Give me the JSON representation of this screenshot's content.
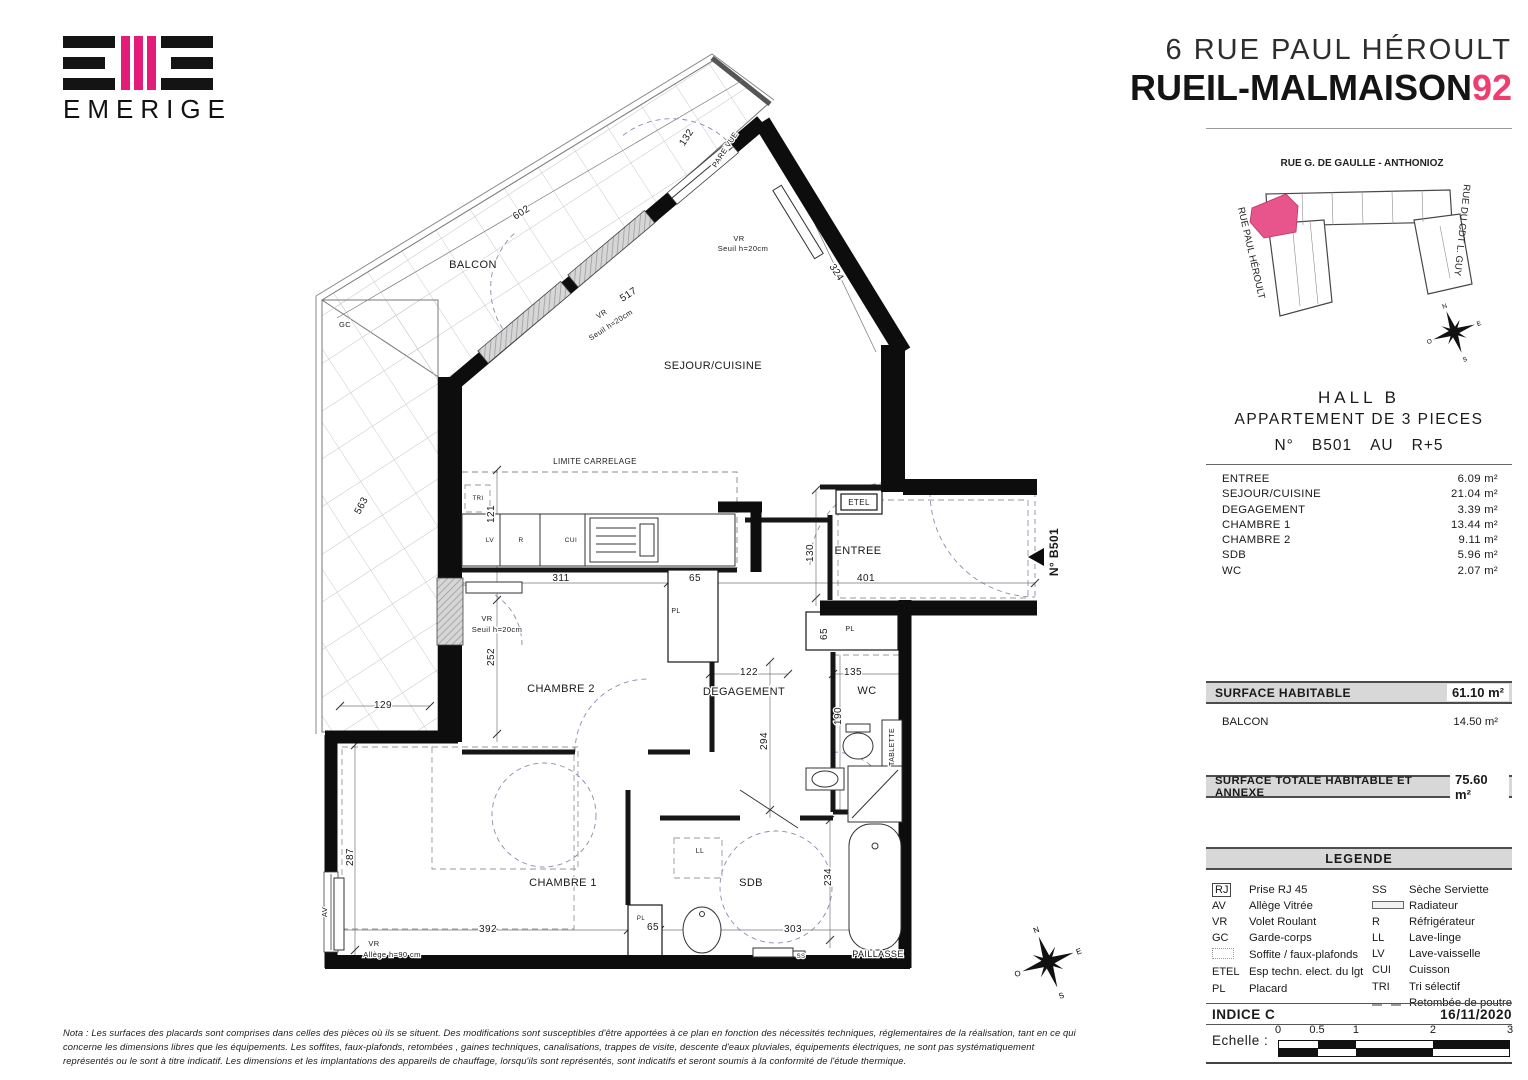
{
  "header": {
    "brand": "EMERIGE",
    "address_line": "6 RUE PAUL HÉROULT",
    "city_line": "RUEIL-MALMAISON",
    "dept": "92"
  },
  "colors": {
    "accent_pink": "#ee3d6e",
    "logo_pink": "#e31c79",
    "map_unit_pink": "#e8548c"
  },
  "map": {
    "street_top": "RUE G. DE GAULLE - ANTHONIOZ",
    "street_left": "RUE PAUL HÉROULT",
    "street_right": "RUE DU CDT L. GUY",
    "compass": {
      "n": "N",
      "e": "E",
      "s": "S",
      "o": "O"
    }
  },
  "unit": {
    "hall": "HALL  B",
    "type": "APPARTEMENT DE 3 PIECES",
    "number_label": "N°",
    "number": "B501",
    "floor_label": "AU",
    "floor": "R+5"
  },
  "rooms": [
    {
      "name": "ENTREE",
      "area": "6.09 m²"
    },
    {
      "name": "SEJOUR/CUISINE",
      "area": "21.04 m²"
    },
    {
      "name": "DEGAGEMENT",
      "area": "3.39 m²"
    },
    {
      "name": "CHAMBRE 1",
      "area": "13.44 m²"
    },
    {
      "name": "CHAMBRE 2",
      "area": "9.11 m²"
    },
    {
      "name": "SDB",
      "area": "5.96 m²"
    },
    {
      "name": "WC",
      "area": "2.07 m²"
    }
  ],
  "surfaces": {
    "habitable_label": "SURFACE HABITABLE",
    "habitable_value": "61.10 m²",
    "balcon_label": "BALCON",
    "balcon_value": "14.50 m²",
    "total_label": "SURFACE TOTALE HABITABLE ET ANNEXE",
    "total_value": "75.60 m²"
  },
  "legend": {
    "title": "LEGENDE",
    "left": [
      {
        "code": "RJ",
        "boxed": true,
        "label": "Prise RJ 45"
      },
      {
        "code": "AV",
        "label": "Allège Vitrée"
      },
      {
        "code": "VR",
        "label": "Volet Roulant"
      },
      {
        "code": "GC",
        "label": "Garde-corps"
      },
      {
        "code": "",
        "swatch": "dotted",
        "label": "Soffite / faux-plafonds"
      },
      {
        "code": "ETEL",
        "label": "Esp techn. elect. du lgt"
      },
      {
        "code": "PL",
        "label": "Placard"
      }
    ],
    "right": [
      {
        "code": "SS",
        "label": "Sèche Serviette"
      },
      {
        "code": "",
        "swatch": "radiator",
        "label": "Radiateur"
      },
      {
        "code": "R",
        "label": "Réfrigérateur"
      },
      {
        "code": "LL",
        "label": "Lave-linge"
      },
      {
        "code": "LV",
        "label": "Lave-vaisselle"
      },
      {
        "code": "CUI",
        "label": "Cuisson"
      },
      {
        "code": "TRI",
        "label": "Tri sélectif"
      },
      {
        "code": "",
        "swatch": "poutre",
        "label": "Retombée de poutre"
      }
    ]
  },
  "revision": {
    "indice": "INDICE C",
    "date": "16/11/2020",
    "scale_label": "Echelle :",
    "scale_ticks": [
      {
        "label": "0",
        "pct": 0
      },
      {
        "label": "0.5",
        "pct": 16.8
      },
      {
        "label": "1",
        "pct": 33.6
      },
      {
        "label": "2",
        "pct": 66.8
      },
      {
        "label": "3",
        "pct": 100
      }
    ]
  },
  "nota": "Nota : Les surfaces des placards sont comprises dans celles des pièces où ils se situent. Des modifications sont susceptibles d'être apportées à ce plan en fonction des nécessités techniques, réglementaires de la réalisation, tant en ce qui concerne les dimensions libres que les équipements. Les soffites, faux-plafonds, retombées , gaines techniques, canalisations, trappes de visite, descente d'eaux pluviales, équipements électriques, ne sont pas systématiquement représentés ou le sont à titre indicatif. Les dimensions et les implantations des appareils de chauffage, lorsqu'ils sont représentés, sont indicatifs et seront soumis à la conformité de l'étude thermique.",
  "plan": {
    "unit_marker": "N° B501",
    "labels": [
      {
        "t": "BALCON",
        "x": 473,
        "y": 268,
        "r": 0,
        "s": 11
      },
      {
        "t": "602",
        "x": 523,
        "y": 215,
        "r": -33,
        "s": 10
      },
      {
        "t": "517",
        "x": 630,
        "y": 297,
        "r": -33,
        "s": 10
      },
      {
        "t": "VR",
        "x": 603,
        "y": 316,
        "r": -33,
        "s": 7.5
      },
      {
        "t": "Seuil h=20cm",
        "x": 612,
        "y": 327,
        "r": -33,
        "s": 7.5
      },
      {
        "t": "VR",
        "x": 739,
        "y": 241,
        "r": 0,
        "s": 7.5
      },
      {
        "t": "Seuil h=20cm",
        "x": 743,
        "y": 251,
        "r": 0,
        "s": 7.5
      },
      {
        "t": "132",
        "x": 689,
        "y": 139,
        "r": -57,
        "s": 10
      },
      {
        "t": "PARE VUE",
        "x": 727,
        "y": 151,
        "r": -57,
        "s": 7.5
      },
      {
        "t": "GC",
        "x": 345,
        "y": 327,
        "r": 0,
        "s": 7.5
      },
      {
        "t": "SEJOUR/CUISINE",
        "x": 713,
        "y": 369,
        "r": 0,
        "s": 11
      },
      {
        "t": "324",
        "x": 834,
        "y": 274,
        "r": 57,
        "s": 10
      },
      {
        "t": "LIMITE CARRELAGE",
        "x": 595,
        "y": 464,
        "r": 0,
        "s": 8
      },
      {
        "t": "563",
        "x": 364,
        "y": 507,
        "r": -62,
        "s": 10
      },
      {
        "t": "121",
        "x": 494,
        "y": 514,
        "r": -90,
        "s": 10
      },
      {
        "t": "TRI",
        "x": 478,
        "y": 500,
        "r": 0,
        "s": 6
      },
      {
        "t": "LV",
        "x": 490,
        "y": 542,
        "r": 0,
        "s": 6.5
      },
      {
        "t": "R",
        "x": 521,
        "y": 542,
        "r": 0,
        "s": 6.5
      },
      {
        "t": "CUI",
        "x": 571,
        "y": 542,
        "r": 0,
        "s": 6.5
      },
      {
        "t": "311",
        "x": 561,
        "y": 581,
        "r": 0,
        "s": 10
      },
      {
        "t": "65",
        "x": 695,
        "y": 581,
        "r": 0,
        "s": 10
      },
      {
        "t": "PL",
        "x": 676,
        "y": 613,
        "r": 0,
        "s": 7
      },
      {
        "t": "130",
        "x": 813,
        "y": 553,
        "r": -90,
        "s": 10
      },
      {
        "t": "ENTREE",
        "x": 858,
        "y": 554,
        "r": 0,
        "s": 11
      },
      {
        "t": "401",
        "x": 866,
        "y": 581,
        "r": 0,
        "s": 10
      },
      {
        "t": "ETEL",
        "x": 859,
        "y": 505,
        "r": 0,
        "s": 8
      },
      {
        "t": "252",
        "x": 494,
        "y": 657,
        "r": -90,
        "s": 10
      },
      {
        "t": "VR",
        "x": 487,
        "y": 621,
        "r": 0,
        "s": 7.5
      },
      {
        "t": "Seuil h=20cm",
        "x": 497,
        "y": 632,
        "r": 0,
        "s": 7.5
      },
      {
        "t": "129",
        "x": 383,
        "y": 708,
        "r": 0,
        "s": 10
      },
      {
        "t": "CHAMBRE 2",
        "x": 561,
        "y": 692,
        "r": 0,
        "s": 11
      },
      {
        "t": "122",
        "x": 749,
        "y": 675,
        "r": 0,
        "s": 10
      },
      {
        "t": "DEGAGEMENT",
        "x": 744,
        "y": 695,
        "r": 0,
        "s": 11
      },
      {
        "t": "135",
        "x": 853,
        "y": 675,
        "r": 0,
        "s": 10
      },
      {
        "t": "WC",
        "x": 867,
        "y": 694,
        "r": 0,
        "s": 11
      },
      {
        "t": "PL",
        "x": 850,
        "y": 631,
        "r": 0,
        "s": 7
      },
      {
        "t": "65",
        "x": 827,
        "y": 634,
        "r": -90,
        "s": 10
      },
      {
        "t": "190",
        "x": 841,
        "y": 716,
        "r": -90,
        "s": 10
      },
      {
        "t": "294",
        "x": 767,
        "y": 741,
        "r": -90,
        "s": 10
      },
      {
        "t": "TABLETTE",
        "x": 894,
        "y": 747,
        "r": -90,
        "s": 7
      },
      {
        "t": "287",
        "x": 353,
        "y": 857,
        "r": -90,
        "s": 10
      },
      {
        "t": "AV",
        "x": 327,
        "y": 912,
        "r": -90,
        "s": 7.5
      },
      {
        "t": "CHAMBRE 1",
        "x": 563,
        "y": 886,
        "r": 0,
        "s": 11
      },
      {
        "t": "392",
        "x": 488,
        "y": 932,
        "r": 0,
        "s": 10
      },
      {
        "t": "65",
        "x": 653,
        "y": 930,
        "r": 0,
        "s": 10
      },
      {
        "t": "PL",
        "x": 641,
        "y": 920,
        "r": 0,
        "s": 6
      },
      {
        "t": "SDB",
        "x": 751,
        "y": 886,
        "r": 0,
        "s": 11
      },
      {
        "t": "303",
        "x": 793,
        "y": 932,
        "r": 0,
        "s": 10
      },
      {
        "t": "234",
        "x": 831,
        "y": 877,
        "r": -90,
        "s": 10
      },
      {
        "t": "LL",
        "x": 700,
        "y": 853,
        "r": 0,
        "s": 7
      },
      {
        "t": "SS",
        "x": 801,
        "y": 958,
        "r": 0,
        "s": 6
      },
      {
        "t": "PAILLASSE",
        "x": 878,
        "y": 957,
        "r": 0,
        "s": 9
      },
      {
        "t": "VR",
        "x": 374,
        "y": 946,
        "r": 0,
        "s": 7.5
      },
      {
        "t": "Allège h=90 cm",
        "x": 392,
        "y": 957,
        "r": 0,
        "s": 7.5
      },
      {
        "t": "N° B501",
        "x": 1058,
        "y": 552,
        "r": -90,
        "s": 12,
        "w": "bold"
      }
    ]
  }
}
